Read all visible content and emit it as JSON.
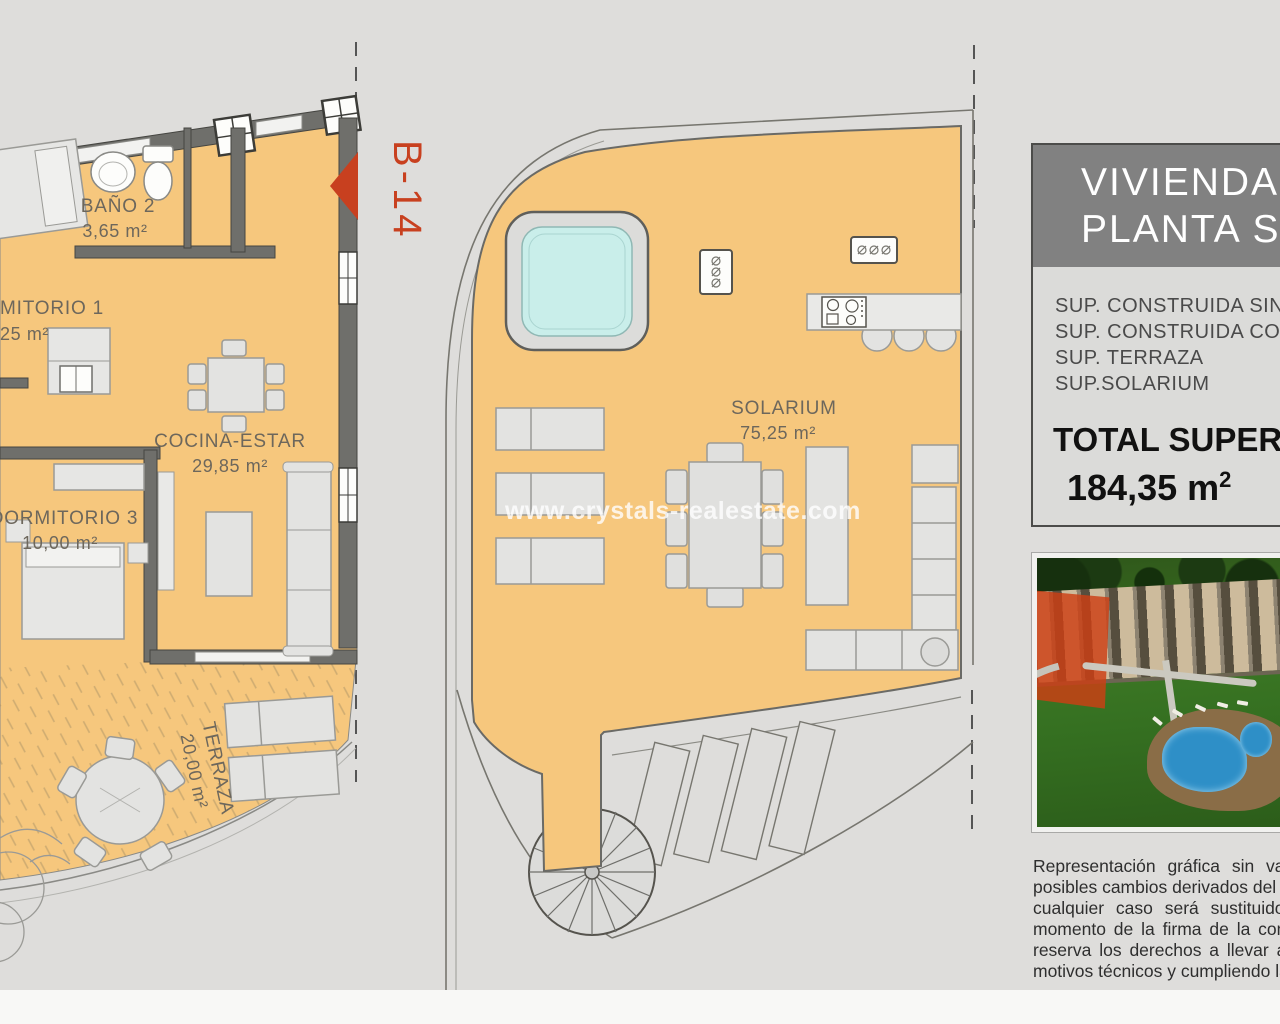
{
  "watermark": {
    "text": "www.crystals-realestate.com",
    "color": "#ffffff"
  },
  "unit_label": {
    "text": "B-14",
    "color": "#c8401f"
  },
  "floorplan_main": {
    "rooms": [
      {
        "name": "BAÑO 2",
        "area": "3,65 m²"
      },
      {
        "name": "MITORIO 1",
        "area": "25 m²"
      },
      {
        "name": "COCINA-ESTAR",
        "area": "29,85 m²"
      },
      {
        "name": "DORMITORIO 3",
        "area": "10,00 m²"
      },
      {
        "name": "TERRAZA",
        "area": "20,00 m²"
      }
    ]
  },
  "floorplan_solarium": {
    "rooms": [
      {
        "name": "SOLARIUM",
        "area": "75,25 m²"
      }
    ]
  },
  "info_panel": {
    "title_line1": "VIVIENDA",
    "title_line2": "PLANTA SEG",
    "rows": [
      "SUP. CONSTRUIDA SIN Z",
      "SUP. CONSTRUIDA CON",
      "SUP. TERRAZA",
      "SUP.SOLARIUM"
    ],
    "total_label": "TOTAL SUPER",
    "total_value": "184,35 m",
    "total_value_sup": "2"
  },
  "disclaimer": {
    "lines": [
      "Representación gráfica sin val",
      "posibles cambios derivados del pr",
      "cualquier caso será sustituido",
      "momento de la firma de la compr",
      "reserva los derechos a llevar a",
      "motivos técnicos y cumpliendo la"
    ]
  },
  "colors": {
    "background": "#dedddb",
    "floor_orange": "#f6c77d",
    "wall_grey": "#6f6f6b",
    "jacuzzi_water": "#c9eeea",
    "accent_red": "#c8401f",
    "header_grey": "#818181",
    "label_brown": "#6d675c"
  }
}
